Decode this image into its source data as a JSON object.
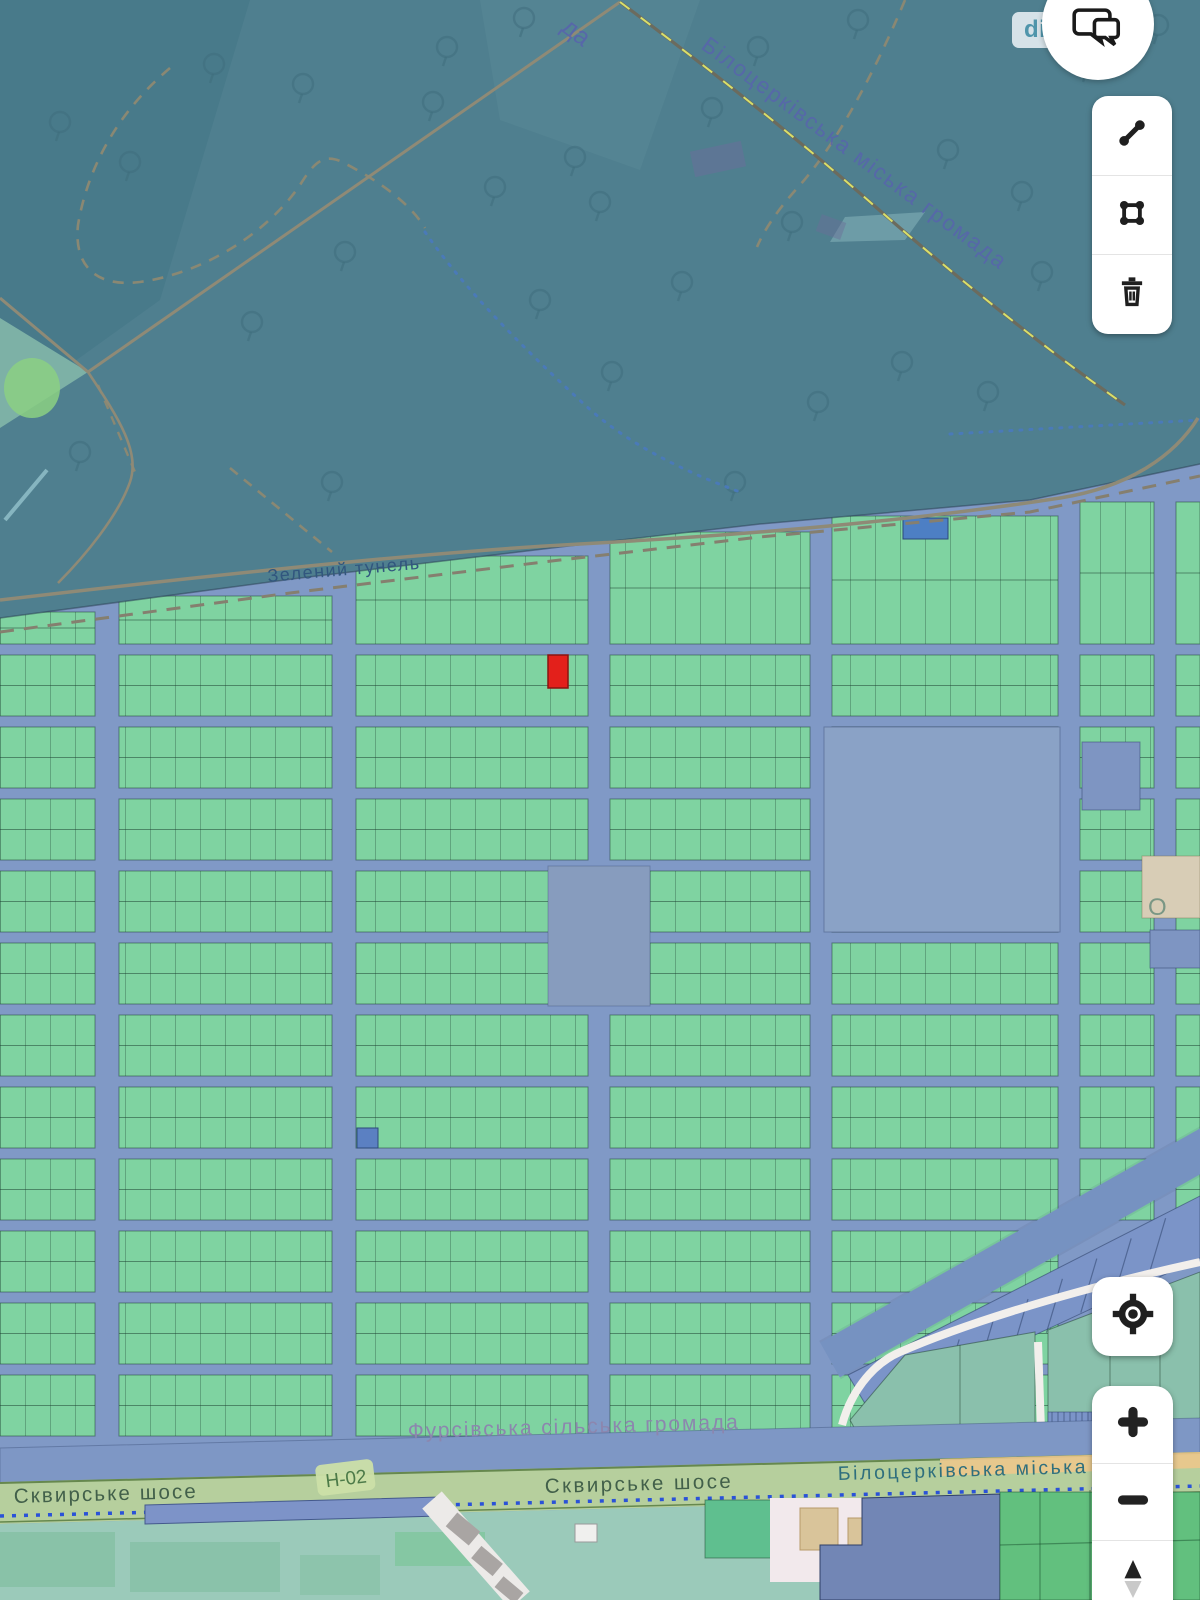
{
  "app": {
    "type": "cadastral-map-viewer"
  },
  "map_labels": {
    "hromada_fragment_top": "да",
    "hromada_boundary": "Білоцерківська міська громада",
    "road_green_tunnel": "Зелений тунель",
    "hromada_fursivska": "Фурсівська сільська громада",
    "highway_name_left": "Сквирське шосе",
    "highway_ref": "Н-02",
    "highway_name_center": "Сквирське шосе",
    "hromada_bilotserkivska_highway": "Білоцерківська міська",
    "place_fragment": "О"
  },
  "controls": {
    "feedback_pill": {
      "label": "dim"
    },
    "chat_button": {
      "icon": "chat-bubbles-icon"
    },
    "draw_toolbar": [
      {
        "icon": "measure-distance-icon"
      },
      {
        "icon": "draw-polygon-icon"
      },
      {
        "icon": "delete-icon"
      }
    ],
    "locate_button": {
      "icon": "gps-locate-icon"
    },
    "zoom_controls": {
      "zoom_in_icon": "plus-icon",
      "zoom_out_icon": "minus-icon",
      "compass_icon": "compass-needle-icon"
    }
  },
  "legend_colors": {
    "parcel_green": "#7fd3a1",
    "road_blue": "#8099c6",
    "selected_parcel_red": "#e3201b",
    "forest_teal": "#4f7f8f",
    "highway_sage": "#b6cf9d"
  }
}
